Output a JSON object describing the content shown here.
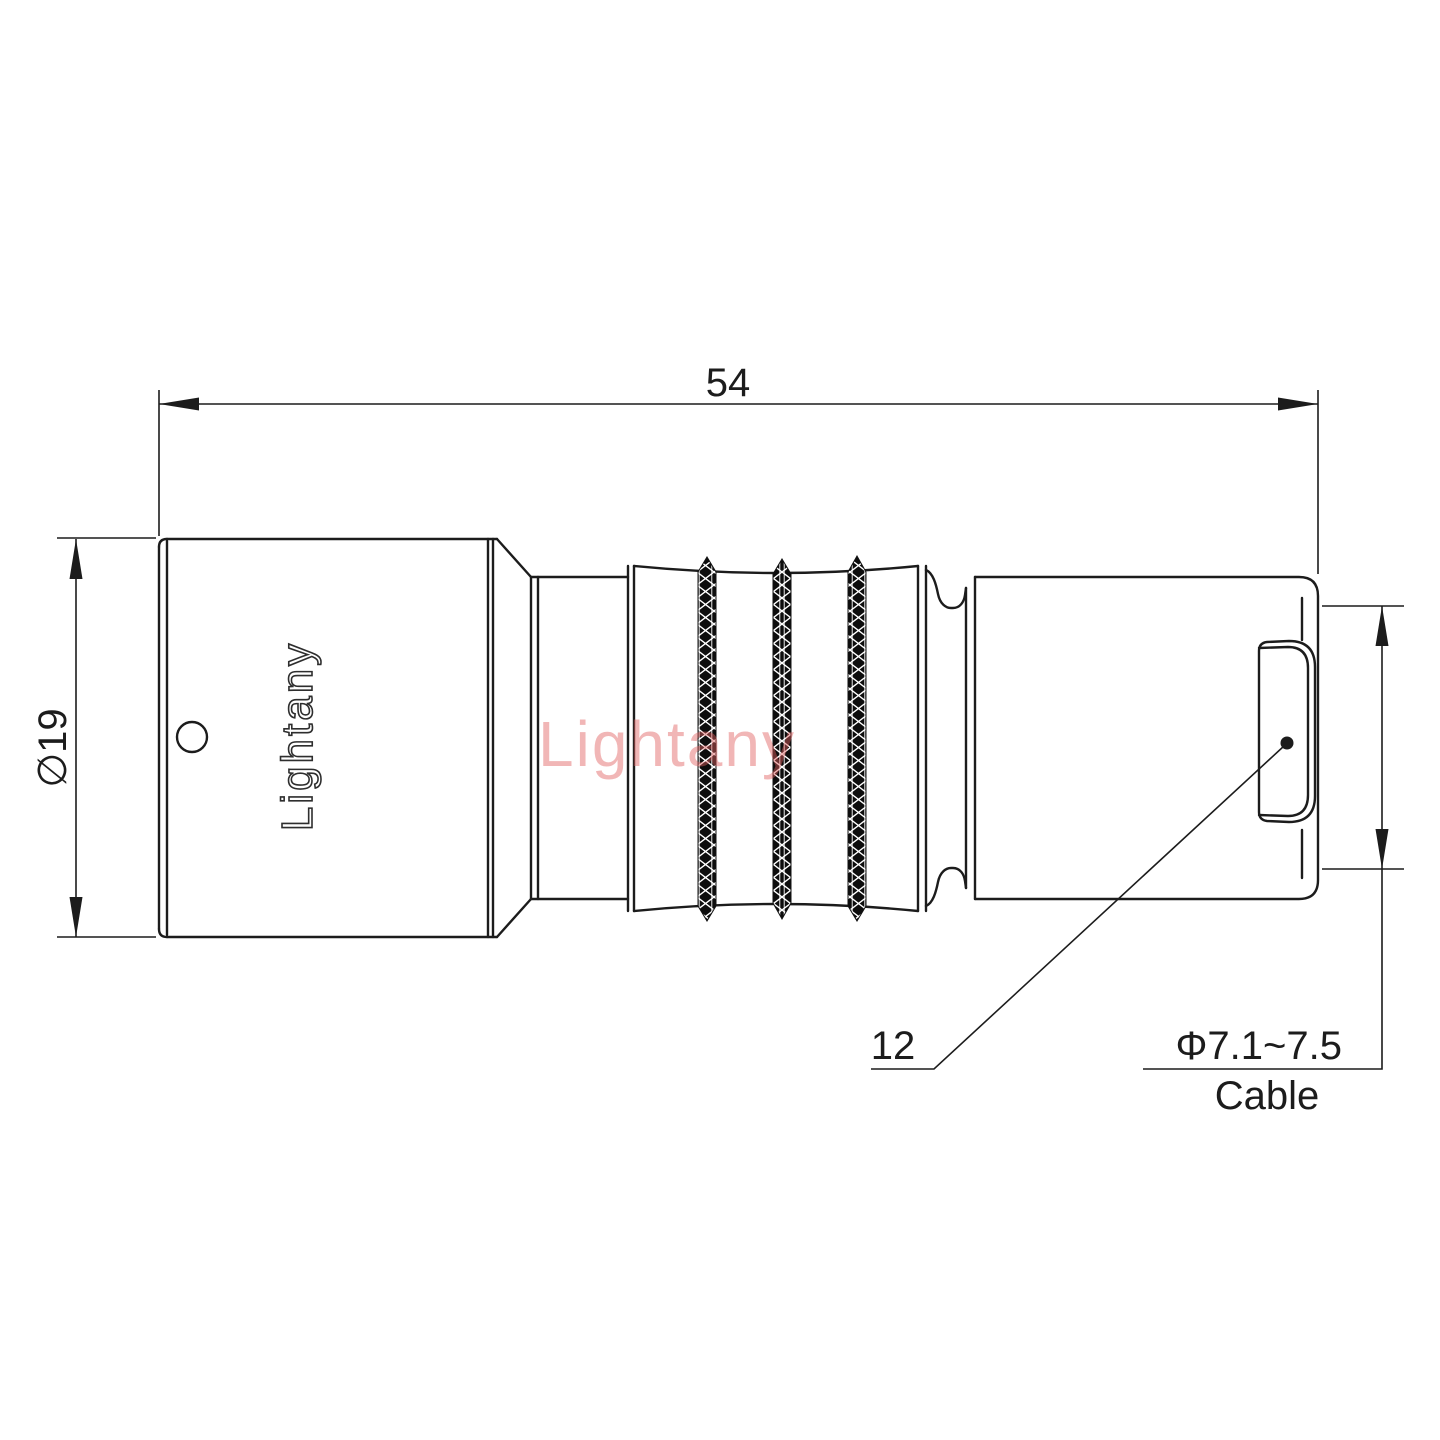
{
  "drawing": {
    "title_hint": "connector technical side view",
    "brand_engraving": "Lightany",
    "watermark": "Lightany",
    "line_color": "#1c1c1c",
    "engraving_color": "#2e2e2e",
    "watermark_color": "#e25f5f",
    "background_color": "#ffffff",
    "dimensions": {
      "overall_length": "54",
      "front_diameter": "∅19",
      "boot_length": "12",
      "cable_diameter": "Φ7.1~7.5",
      "cable_word": "Cable"
    }
  }
}
